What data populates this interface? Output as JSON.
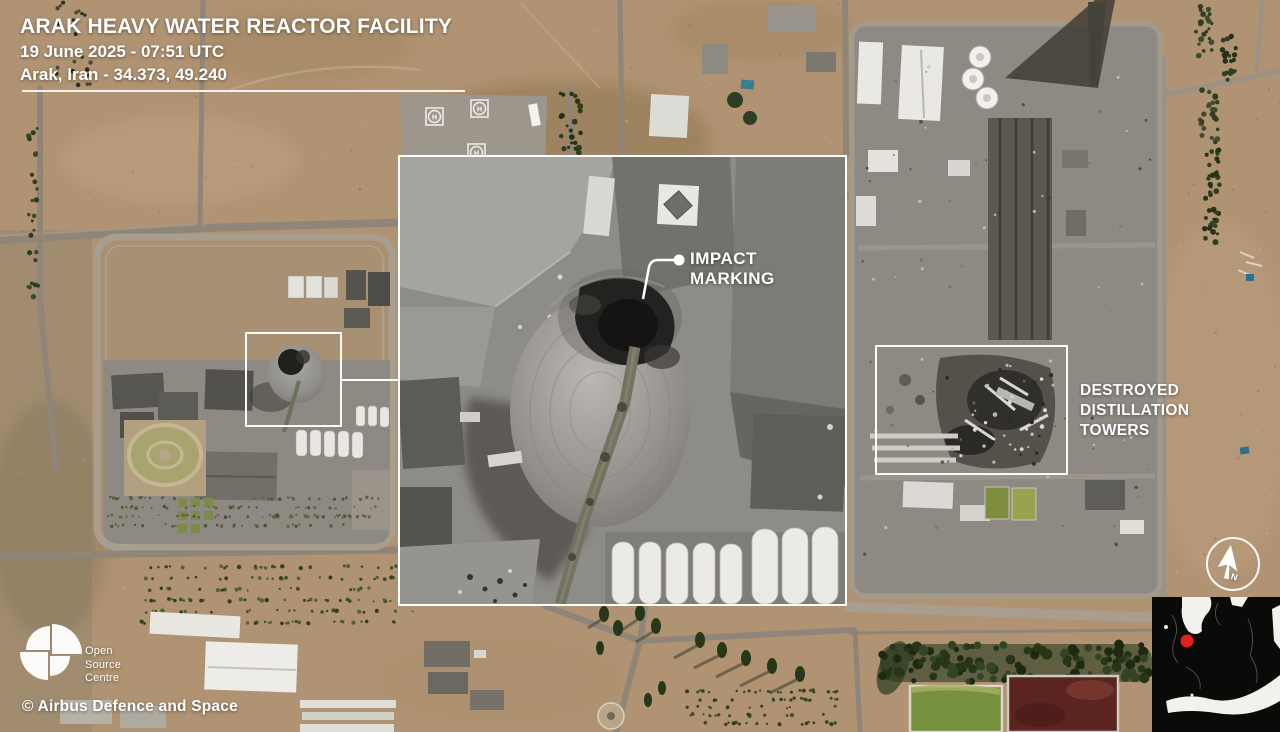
{
  "title_block": {
    "title": "ARAK HEAVY WATER REACTOR FACILITY",
    "datetime": "19 June 2025 - 07:51 UTC",
    "location": "Arak, Iran - 34.373, 49.240"
  },
  "callouts": {
    "impact": "IMPACT MARKING",
    "destroyed": "DESTROYED\nDISTILLATION\nTOWERS"
  },
  "branding": {
    "logo_text": "Open\nSource\nCentre",
    "credit": "© Airbus Defence and Space"
  },
  "compass": {
    "north": "N"
  },
  "ground_marks": {
    "helipad": "H"
  },
  "colors": {
    "annotation_white": "#ffffff",
    "marker_red": "#e3211c",
    "map_background": "#0a0a09",
    "pond_green": "#77903e",
    "pond_red": "#5c2421",
    "tree_green": "#2c3a21",
    "desert_tan": "#b09372",
    "road_gray": "#8f8679",
    "pavement_gray": "#8e8a83"
  }
}
